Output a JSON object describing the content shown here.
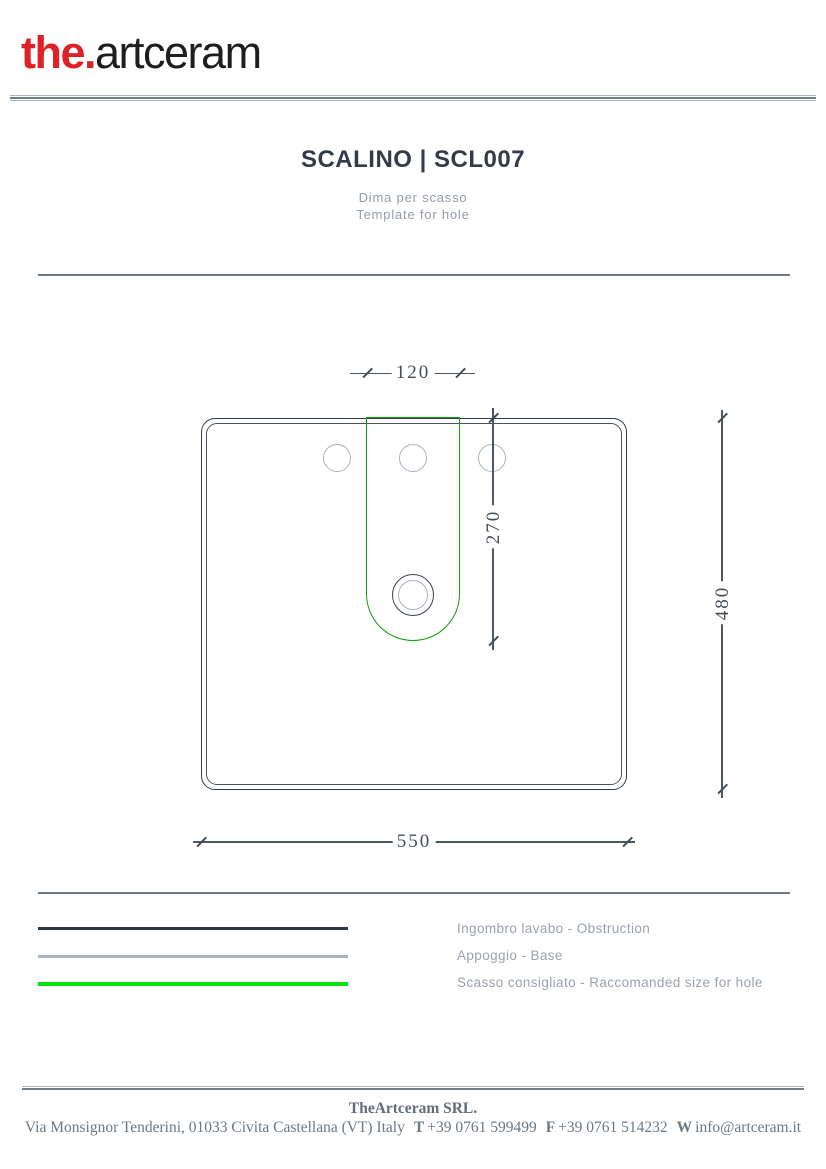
{
  "brand": {
    "logo_the": "the.",
    "logo_rest": "artceram",
    "logo_red": "#dd2127"
  },
  "header": {
    "title": "SCALINO | SCL007",
    "subtitle_it": "Dima per scasso",
    "subtitle_en": "Template for hole"
  },
  "drawing": {
    "dims": {
      "top_width": "120",
      "hole_depth": "270",
      "overall_depth": "480",
      "overall_width": "550"
    },
    "features": {
      "tap_holes_count": 3,
      "drain": "concentric-circles"
    },
    "colors": {
      "obstruction_line": "#333d49",
      "base_line": "#49535f",
      "hole_template_line": "#0b9f0b",
      "tap_hole_line": "#a9b2bd",
      "dimension_text": "#434d58"
    }
  },
  "legend": {
    "items": [
      {
        "label": "Ingombro lavabo - Obstruction",
        "color": "#2f3945"
      },
      {
        "label": "Appoggio - Base",
        "color": "#a9b2bd"
      },
      {
        "label": "Scasso consigliato - Raccomanded size for hole",
        "color": "#00e40a"
      }
    ]
  },
  "footer": {
    "company": "TheArtceram SRL.",
    "address": "Via Monsignor Tenderini, 01033 Civita Castellana (VT) Italy",
    "phone_label": "T",
    "phone": "+39 0761 599499",
    "fax_label": "F",
    "fax": "+39 0761 514232",
    "web_label": "W",
    "email": "info@artceram.it"
  }
}
